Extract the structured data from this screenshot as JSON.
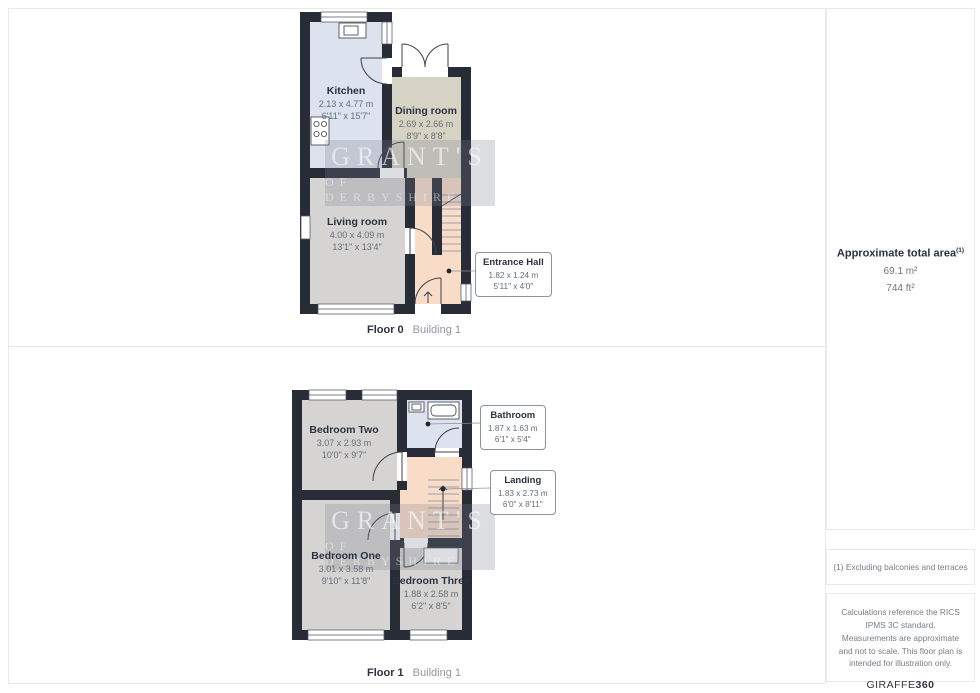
{
  "floor0": {
    "caption": {
      "floor": "Floor 0",
      "building": "Building 1"
    },
    "kitchen": {
      "name": "Kitchen",
      "m": "2.13 x 4.77 m",
      "ft": "6'11\" x 15'7\""
    },
    "dining": {
      "name": "Dining room",
      "m": "2.69 x 2.66 m",
      "ft": "8'9\" x 8'8\""
    },
    "living": {
      "name": "Living room",
      "m": "4.00 x 4.09 m",
      "ft": "13'1\" x 13'4\""
    },
    "entrance": {
      "name": "Entrance Hall",
      "m": "1.82 x 1.24 m",
      "ft": "5'11\" x 4'0\""
    }
  },
  "floor1": {
    "caption": {
      "floor": "Floor 1",
      "building": "Building 1"
    },
    "bedroom_two": {
      "name": "Bedroom Two",
      "m": "3.07 x 2.93 m",
      "ft": "10'0\" x 9'7\""
    },
    "bathroom": {
      "name": "Bathroom",
      "m": "1.87 x 1.63 m",
      "ft": "6'1\" x 5'4\""
    },
    "landing": {
      "name": "Landing",
      "m": "1.83 x 2.73 m",
      "ft": "6'0\" x 8'11\""
    },
    "bedroom_one": {
      "name": "Bedroom One",
      "m": "3.01 x 3.58 m",
      "ft": "9'10\" x 11'8\""
    },
    "bedroom_three": {
      "name": "Bedroom Three",
      "m": "1.88 x 2.58 m",
      "ft": "6'2\" x 8'5\""
    }
  },
  "watermark": {
    "line1": "GRANT'S",
    "line2": "OF DERBYSHIRE"
  },
  "sidebar": {
    "area_title": "Approximate total area",
    "area_sup": "(1)",
    "area_m2": "69.1 m²",
    "area_ft2": "744 ft²",
    "note1": "(1) Excluding balconies and terraces",
    "disclaimer": "Calculations reference the RICS IPMS 3C standard. Measurements are approximate and not to scale. This floor plan is intended for illustration only.",
    "brand": "GIRAFFE",
    "brand_bold": "360"
  },
  "colors": {
    "wall": "#272c37",
    "kitchen_bathroom_floor": "#dce2ee",
    "dining_floor": "#d6d3c4",
    "bedroom_living_floor": "#d5d4d2",
    "hall_landing_floor": "#f8dcc8",
    "panel_border": "#e9e9e9",
    "label_title": "#2b3140",
    "label_dim": "#676d78"
  }
}
